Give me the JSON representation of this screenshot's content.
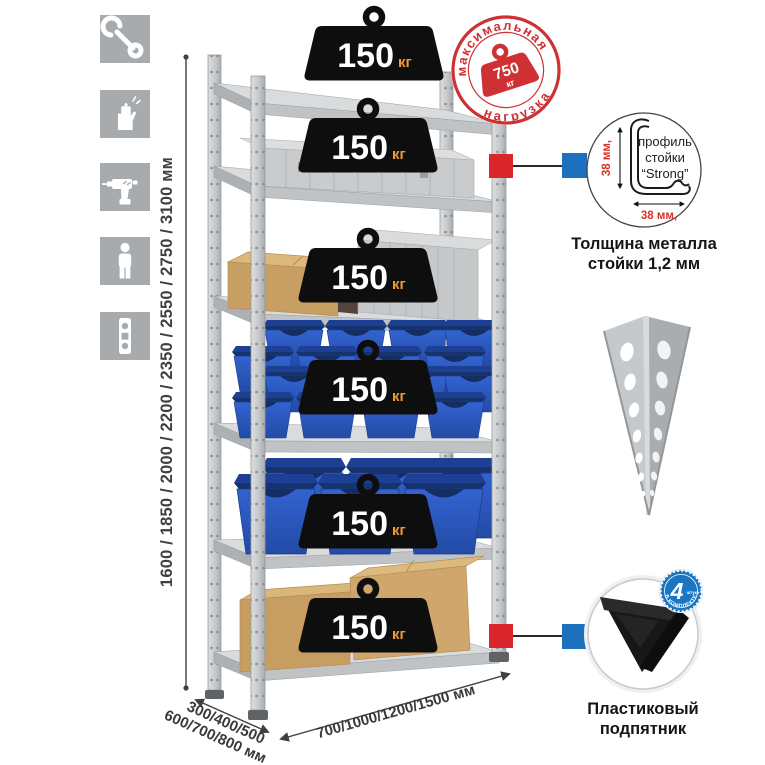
{
  "canvas": {
    "width": 765,
    "height": 765,
    "background": "#ffffff"
  },
  "colors": {
    "tile_gray": "#a7abad",
    "metal_light": "#d9dbdc",
    "metal_mid": "#c0c3c5",
    "metal_dark": "#9b9ea1",
    "weight_black": "#0e0e0e",
    "weight_unit_orange": "#ef9b3a",
    "stamp_red": "#cf3034",
    "callout_red": "#d8262c",
    "callout_blue": "#1c71bf",
    "badge_blue": "#1b76c2",
    "bin_blue": "#2a5ac2",
    "cardboard": "#c89f63",
    "dimension_text": "#3a3a3a",
    "red_dimension_text": "#d43528"
  },
  "feature_icons": [
    {
      "name": "wrench-icon"
    },
    {
      "name": "gloves-icon"
    },
    {
      "name": "drill-icon"
    },
    {
      "name": "person-icon"
    },
    {
      "name": "level-icon"
    }
  ],
  "height_dimension": {
    "label": "1600 / 1850 / 2000 / 2200 / 2350 / 2550 / 2750 / 3100 мм"
  },
  "max_load_stamp": {
    "arc_top": "максимальная",
    "arc_bottom": "нагрузка",
    "value": "750",
    "unit": "кг"
  },
  "shelf_weight": {
    "value": "150",
    "unit": "кг",
    "shelf_count": 6
  },
  "profile_detail": {
    "dim_vertical": "38 мм,",
    "dim_horizontal": "38 мм,",
    "label_line1": "профиль",
    "label_line2": "стойки",
    "label_line3": "“Strong”",
    "caption_line1": "Толщина металла",
    "caption_line2": "стойки 1,2 мм"
  },
  "foot_detail": {
    "badge_value": "4",
    "badge_side": "штуки",
    "badge_arc": "в комплекте",
    "caption_line1": "Пластиковый",
    "caption_line2": "подпятник"
  },
  "base_dimensions": {
    "depth_line1": "300/400/500",
    "depth_line2": "600/700/800 мм",
    "width_label": "700/1000/1200/1500 мм"
  }
}
